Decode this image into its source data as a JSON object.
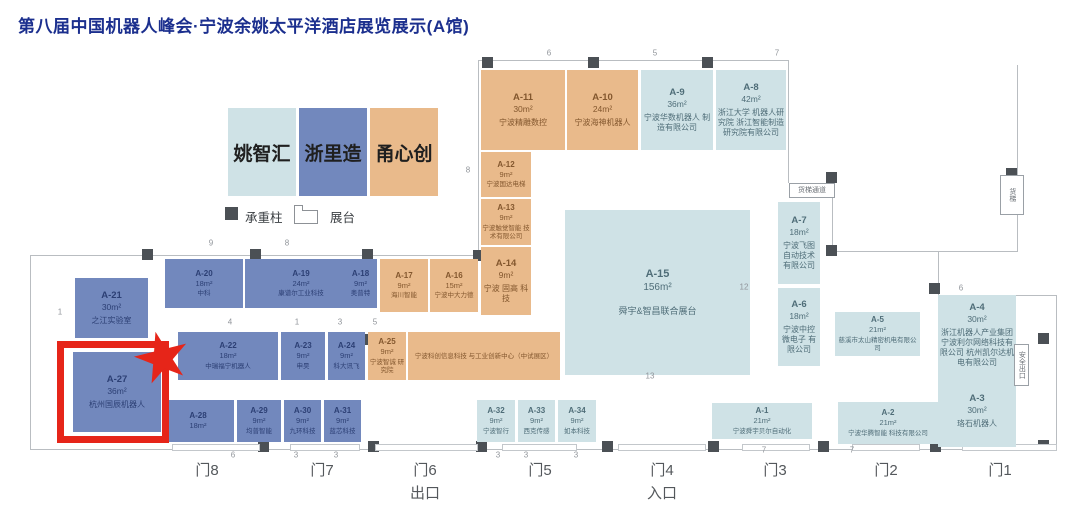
{
  "title": "第八届中国机器人峰会·宁波余姚太平洋酒店展览展示(A馆)",
  "legend": {
    "categories": [
      {
        "key": "yao",
        "label": "姚智汇",
        "color": "#cfe2e6",
        "text_color": "#4f6d78"
      },
      {
        "key": "zhe",
        "label": "浙里造",
        "color": "#7288bd",
        "text_color": "#2c3f74"
      },
      {
        "key": "yong",
        "label": "甬心创",
        "color": "#e9ba8b",
        "text_color": "#83572e"
      }
    ],
    "column_label": "承重柱",
    "booth_label": "展台"
  },
  "highlight": {
    "booth_id": "A-27",
    "color": "#e62519",
    "rect": [
      57,
      341,
      112,
      102
    ],
    "star": [
      134,
      331,
      56,
      54
    ]
  },
  "booths": [
    {
      "id": "A-11",
      "size": "30m²",
      "company": "宁波精雕数控",
      "cat": "yong",
      "x": 481,
      "y": 70,
      "w": 84,
      "h": 80
    },
    {
      "id": "A-10",
      "size": "24m²",
      "company": "宁波海神机器人",
      "cat": "yong",
      "x": 567,
      "y": 70,
      "w": 71,
      "h": 80
    },
    {
      "id": "A-9",
      "size": "36m²",
      "company": "宁波华数机器人 制造有限公司",
      "cat": "yao",
      "x": 641,
      "y": 70,
      "w": 72,
      "h": 80
    },
    {
      "id": "A-8",
      "size": "42m²",
      "company": "浙江大学 机器人研究院 浙江智能制造 研究院有限公司",
      "cat": "yao",
      "x": 716,
      "y": 70,
      "w": 70,
      "h": 80
    },
    {
      "id": "A-12",
      "size": "9m²",
      "company": "宁波国达电梯",
      "cat": "yong",
      "x": 481,
      "y": 152,
      "w": 50,
      "h": 45
    },
    {
      "id": "A-13",
      "size": "9m²",
      "company": "宁波触觉智能 技术有限公司",
      "cat": "yong",
      "x": 481,
      "y": 199,
      "w": 50,
      "h": 46
    },
    {
      "id": "A-14",
      "size": "9m²",
      "company": "宁波 固高 科技",
      "cat": "yong",
      "x": 481,
      "y": 247,
      "w": 50,
      "h": 68
    },
    {
      "id": "A-21",
      "size": "30m²",
      "company": "之江实验室",
      "cat": "zhe",
      "x": 75,
      "y": 278,
      "w": 73,
      "h": 60
    },
    {
      "id": "A-20",
      "size": "18m²",
      "company": "中科",
      "cat": "zhe",
      "x": 165,
      "y": 259,
      "w": 78,
      "h": 49
    },
    {
      "id": "A-19",
      "size": "24m²",
      "company": "康谱尔工业科技",
      "cat": "zhe",
      "x": 245,
      "y": 259,
      "w": 112,
      "h": 49
    },
    {
      "id": "A-18",
      "size": "9m²",
      "company": "奥普特",
      "cat": "zhe",
      "x": 344,
      "y": 259,
      "w": 33,
      "h": 49
    },
    {
      "id": "A-17",
      "size": "9m²",
      "company": "海川智能",
      "cat": "yong",
      "x": 380,
      "y": 259,
      "w": 48,
      "h": 53
    },
    {
      "id": "A-16",
      "size": "15m²",
      "company": "宁波中大力德",
      "cat": "yong",
      "x": 430,
      "y": 259,
      "w": 48,
      "h": 53
    },
    {
      "id": "A-22",
      "size": "18m²",
      "company": "中瑞福宁机器人",
      "cat": "zhe",
      "x": 178,
      "y": 332,
      "w": 100,
      "h": 48
    },
    {
      "id": "A-23",
      "size": "9m²",
      "company": "申昊",
      "cat": "zhe",
      "x": 281,
      "y": 332,
      "w": 44,
      "h": 48
    },
    {
      "id": "A-24",
      "size": "9m²",
      "company": "科大讯飞",
      "cat": "zhe",
      "x": 328,
      "y": 332,
      "w": 37,
      "h": 48
    },
    {
      "id": "A-25",
      "size": "9m²",
      "company": "宁波智诚 研究院",
      "cat": "yong",
      "x": 368,
      "y": 332,
      "w": 38,
      "h": 48
    },
    {
      "id": "",
      "size": "",
      "company": "宁波科创信息科技 与工业创新中心（中试展区）",
      "cat": "yong",
      "x": 408,
      "y": 332,
      "w": 152,
      "h": 48
    },
    {
      "id": "A-27",
      "size": "36m²",
      "company": "杭州国辰机器人",
      "cat": "zhe",
      "x": 73,
      "y": 352,
      "w": 88,
      "h": 80
    },
    {
      "id": "A-28",
      "size": "18m²",
      "company": "",
      "cat": "zhe",
      "x": 162,
      "y": 400,
      "w": 72,
      "h": 42
    },
    {
      "id": "A-29",
      "size": "9m²",
      "company": "均普智能",
      "cat": "zhe",
      "x": 237,
      "y": 400,
      "w": 44,
      "h": 42
    },
    {
      "id": "A-30",
      "size": "9m²",
      "company": "九环科技",
      "cat": "zhe",
      "x": 284,
      "y": 400,
      "w": 37,
      "h": 42
    },
    {
      "id": "A-31",
      "size": "9m²",
      "company": "蓝芯科技",
      "cat": "zhe",
      "x": 324,
      "y": 400,
      "w": 37,
      "h": 42
    },
    {
      "id": "A-15",
      "size": "156m²",
      "company": "舜宇&智昌联合展台",
      "cat": "yao",
      "x": 565,
      "y": 210,
      "w": 185,
      "h": 165
    },
    {
      "id": "A-32",
      "size": "9m²",
      "company": "宁波智行",
      "cat": "yao",
      "x": 477,
      "y": 400,
      "w": 38,
      "h": 42
    },
    {
      "id": "A-33",
      "size": "9m²",
      "company": "西克传感",
      "cat": "yao",
      "x": 518,
      "y": 400,
      "w": 37,
      "h": 42
    },
    {
      "id": "A-34",
      "size": "9m²",
      "company": "如本科技",
      "cat": "yao",
      "x": 558,
      "y": 400,
      "w": 38,
      "h": 42
    },
    {
      "id": "A-7",
      "size": "18m²",
      "company": "宁波飞图 自动技术 有限公司",
      "cat": "yao",
      "x": 778,
      "y": 202,
      "w": 42,
      "h": 82
    },
    {
      "id": "A-6",
      "size": "18m²",
      "company": "宁波中控 微电子 有限公司",
      "cat": "yao",
      "x": 778,
      "y": 288,
      "w": 42,
      "h": 78
    },
    {
      "id": "A-5",
      "size": "21m²",
      "company": "慈溪市太山精密机电有限公司",
      "cat": "yao",
      "x": 835,
      "y": 312,
      "w": 85,
      "h": 44
    },
    {
      "id": "A-4",
      "size": "30m²",
      "company": "浙江机器人产业集团 宁波利尔网络科技有限公司 杭州凯尔达机电有限公司",
      "cat": "yao",
      "x": 938,
      "y": 295,
      "w": 78,
      "h": 80
    },
    {
      "id": "A-3",
      "size": "30m²",
      "company": "珞石机器人",
      "cat": "yao",
      "x": 938,
      "y": 375,
      "w": 78,
      "h": 72
    },
    {
      "id": "A-2",
      "size": "21m²",
      "company": "宁波华腾智能 科技有限公司",
      "cat": "yao",
      "x": 838,
      "y": 402,
      "w": 100,
      "h": 42
    },
    {
      "id": "A-1",
      "size": "21m²",
      "company": "宁波舜宇贝尔自动化",
      "cat": "yao",
      "x": 712,
      "y": 403,
      "w": 100,
      "h": 36
    }
  ],
  "doors": [
    {
      "label": "门8",
      "sub": "",
      "x": 207
    },
    {
      "label": "门7",
      "sub": "",
      "x": 322
    },
    {
      "label": "门6",
      "sub": "出口",
      "x": 425
    },
    {
      "label": "门5",
      "sub": "",
      "x": 540
    },
    {
      "label": "门4",
      "sub": "入口",
      "x": 662
    },
    {
      "label": "门3",
      "sub": "",
      "x": 775
    },
    {
      "label": "门2",
      "sub": "",
      "x": 886
    },
    {
      "label": "门1",
      "sub": "",
      "x": 1000
    }
  ],
  "door_gaps": [
    [
      172,
      88
    ],
    [
      290,
      70
    ],
    [
      375,
      103
    ],
    [
      502,
      75
    ],
    [
      618,
      88
    ],
    [
      742,
      68
    ],
    [
      852,
      68
    ],
    [
      962,
      95
    ]
  ],
  "walls": [
    [
      30,
      255,
      449,
      1
    ],
    [
      30,
      255,
      1,
      195
    ],
    [
      30,
      449,
      1027,
      1
    ],
    [
      478,
      60,
      1,
      196
    ],
    [
      478,
      60,
      311,
      1
    ],
    [
      788,
      60,
      1,
      123
    ],
    [
      832,
      178,
      1,
      74
    ],
    [
      832,
      251,
      185,
      1
    ],
    [
      1017,
      65,
      1,
      187
    ],
    [
      938,
      251,
      1,
      45
    ],
    [
      938,
      295,
      119,
      1
    ],
    [
      1056,
      295,
      1,
      155
    ]
  ],
  "pillars": [
    [
      482,
      57
    ],
    [
      588,
      57
    ],
    [
      702,
      57
    ],
    [
      142,
      249
    ],
    [
      250,
      249
    ],
    [
      362,
      249
    ],
    [
      473,
      250
    ],
    [
      262,
      334
    ],
    [
      360,
      334
    ],
    [
      588,
      250,
      15,
      10
    ],
    [
      704,
      252,
      11,
      10
    ],
    [
      586,
      333,
      16,
      11
    ],
    [
      702,
      335,
      12,
      11
    ],
    [
      826,
      172
    ],
    [
      826,
      245
    ],
    [
      1006,
      168
    ],
    [
      929,
      283
    ],
    [
      1038,
      333
    ],
    [
      258,
      441
    ],
    [
      368,
      441
    ],
    [
      476,
      441
    ],
    [
      602,
      441
    ],
    [
      708,
      441
    ],
    [
      818,
      441
    ],
    [
      930,
      441
    ],
    [
      1038,
      440
    ]
  ],
  "wall_numbers": [
    {
      "t": "9",
      "x": 211,
      "y": 243
    },
    {
      "t": "8",
      "x": 287,
      "y": 243
    },
    {
      "t": "1",
      "x": 60,
      "y": 312
    },
    {
      "t": "6",
      "x": 549,
      "y": 53
    },
    {
      "t": "5",
      "x": 655,
      "y": 53
    },
    {
      "t": "7",
      "x": 777,
      "y": 53
    },
    {
      "t": "8",
      "x": 468,
      "y": 170
    },
    {
      "t": "12",
      "x": 744,
      "y": 287
    },
    {
      "t": "13",
      "x": 650,
      "y": 376
    },
    {
      "t": "6",
      "x": 961,
      "y": 288
    },
    {
      "t": "4",
      "x": 230,
      "y": 322
    },
    {
      "t": "1",
      "x": 297,
      "y": 322
    },
    {
      "t": "3",
      "x": 340,
      "y": 322
    },
    {
      "t": "5",
      "x": 375,
      "y": 322
    },
    {
      "t": "6",
      "x": 233,
      "y": 455
    },
    {
      "t": "3",
      "x": 296,
      "y": 455
    },
    {
      "t": "3",
      "x": 336,
      "y": 455
    },
    {
      "t": "3",
      "x": 498,
      "y": 455
    },
    {
      "t": "3",
      "x": 526,
      "y": 455
    },
    {
      "t": "3",
      "x": 576,
      "y": 455
    },
    {
      "t": "7",
      "x": 764,
      "y": 450
    },
    {
      "t": "7",
      "x": 852,
      "y": 450
    }
  ],
  "annotations": [
    {
      "text": "货梯通道",
      "x": 789,
      "y": 183,
      "w": 46,
      "h": 15,
      "vertical": false
    },
    {
      "text": "货梯",
      "x": 1000,
      "y": 175,
      "w": 24,
      "h": 40,
      "vertical": true
    },
    {
      "text": "安全出口",
      "x": 1014,
      "y": 344,
      "w": 15,
      "h": 42,
      "vertical": true
    }
  ]
}
